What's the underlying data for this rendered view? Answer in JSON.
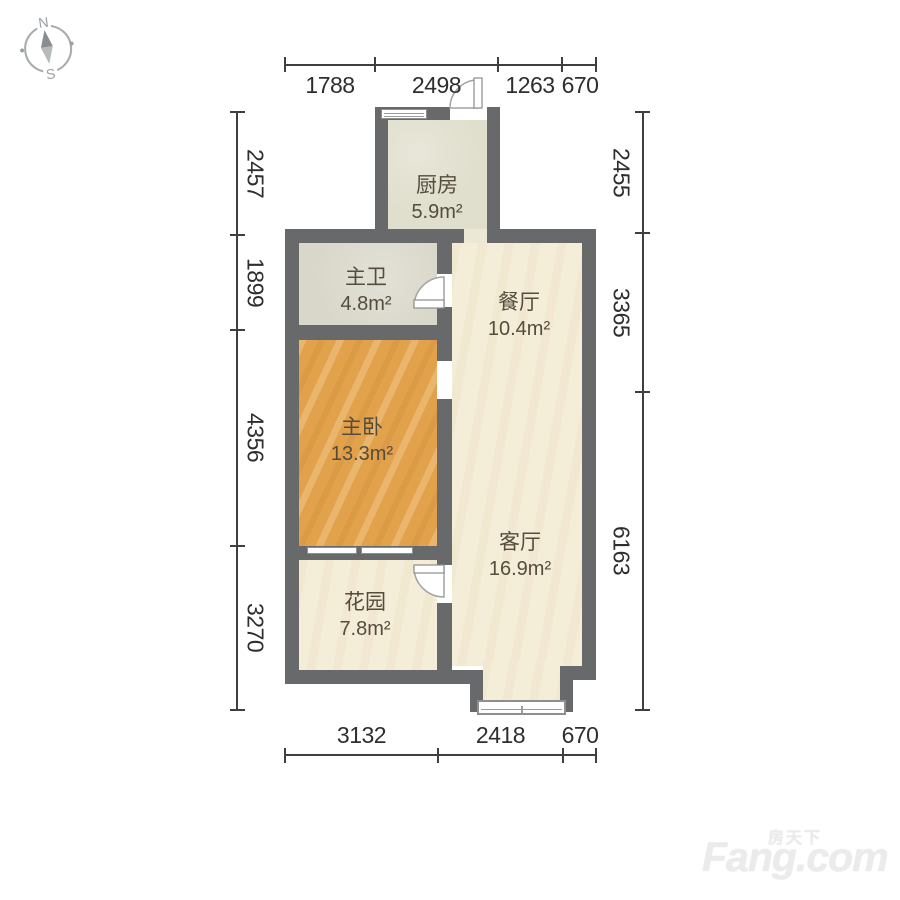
{
  "compass": {
    "north": "N",
    "south": "S"
  },
  "dimensions": {
    "top": [
      "1788",
      "2498",
      "1263",
      "670"
    ],
    "bottom": [
      "3132",
      "2418",
      "670"
    ],
    "left": [
      "2457",
      "1899",
      "4356",
      "3270"
    ],
    "right": [
      "2455",
      "3365",
      "6163"
    ]
  },
  "rooms": {
    "kitchen": {
      "name": "厨房",
      "area": "5.9m²"
    },
    "bathroom": {
      "name": "主卫",
      "area": "4.8m²"
    },
    "dining": {
      "name": "餐厅",
      "area": "10.4m²"
    },
    "bedroom": {
      "name": "主卧",
      "area": "13.3m²"
    },
    "living": {
      "name": "客厅",
      "area": "16.9m²"
    },
    "garden": {
      "name": "花园",
      "area": "7.8m²"
    }
  },
  "watermark": {
    "cn": "房天下",
    "en": "Fang.com"
  },
  "colors": {
    "wall": "#67696a",
    "floor_cream": "#f4edd8",
    "floor_kitchen": "#e0decc",
    "floor_bath": "#d9d7c9",
    "floor_bedroom": "#e2a14b",
    "dimension_text": "#2e2e2e"
  }
}
